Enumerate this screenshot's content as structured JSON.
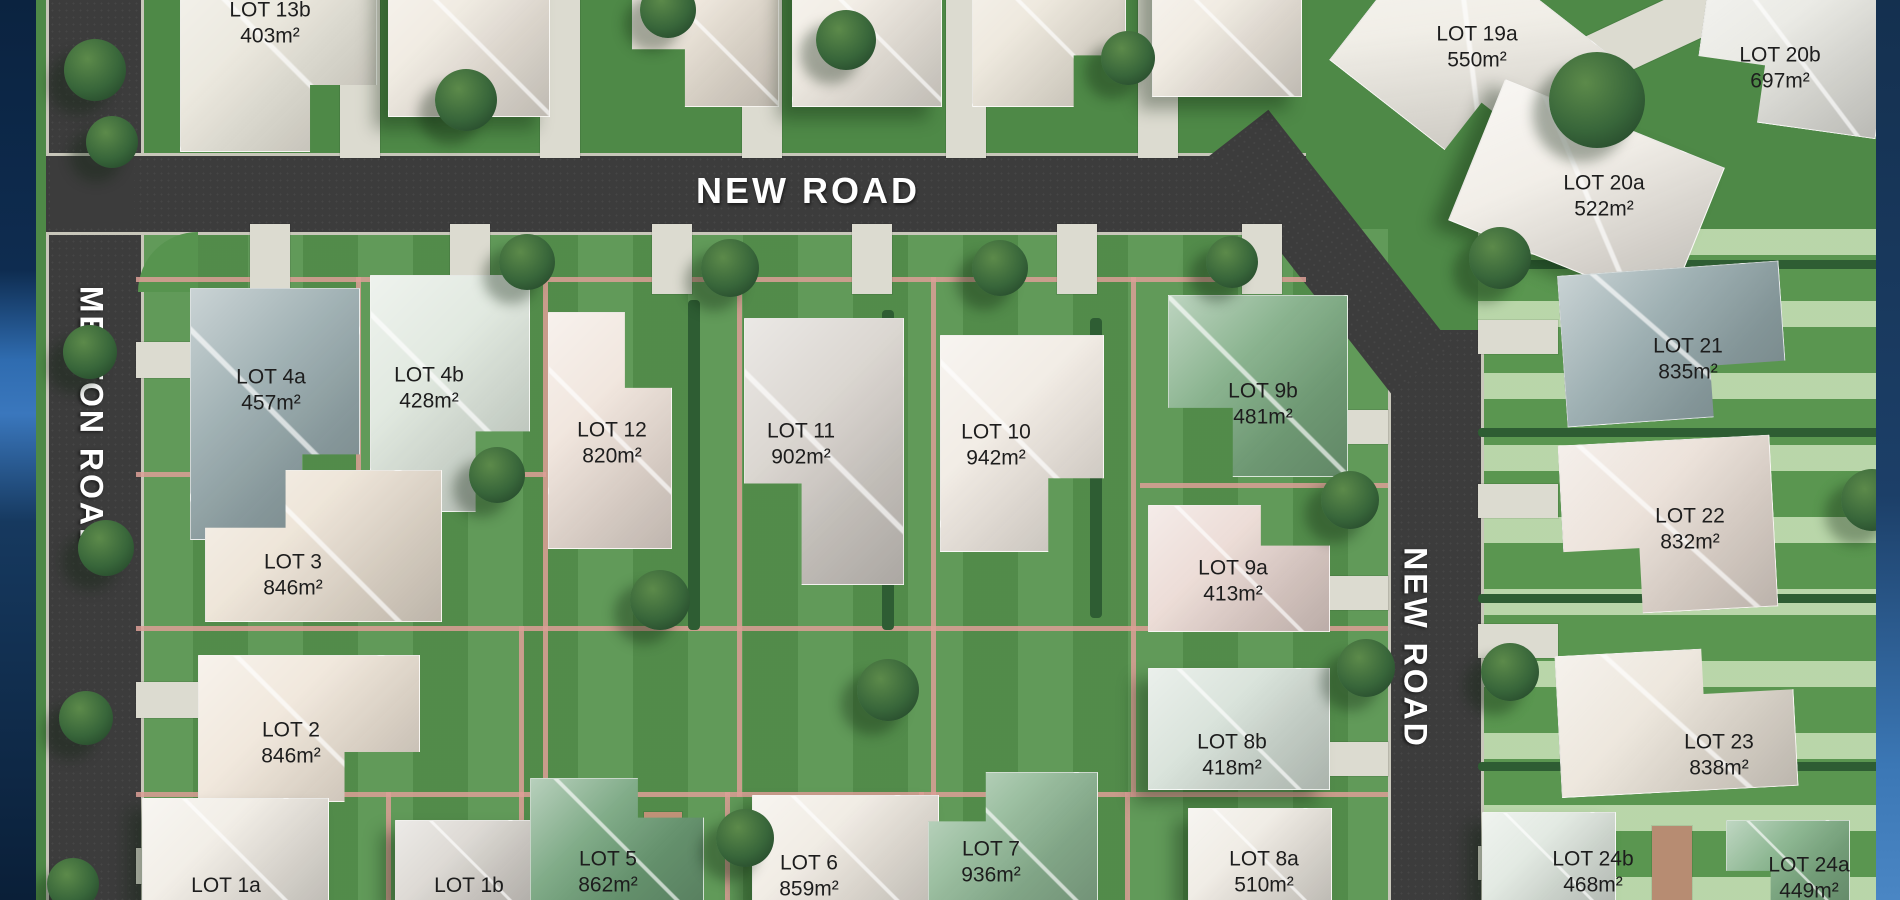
{
  "roads": {
    "melton": {
      "label": "MELTON ROAD",
      "x": 91,
      "y": 420,
      "orientation": "vertical"
    },
    "new_top": {
      "label": "NEW ROAD",
      "x": 808,
      "y": 191,
      "orientation": "horizontal"
    },
    "new_right": {
      "label": "NEW ROAD",
      "x": 1415,
      "y": 648,
      "orientation": "vertical"
    }
  },
  "lots": [
    {
      "id": "LOT 13b",
      "area": "403m²",
      "x": 270,
      "y": 23
    },
    {
      "id": "LOT 19a",
      "area": "550m²",
      "x": 1477,
      "y": 47
    },
    {
      "id": "LOT 20b",
      "area": "697m²",
      "x": 1780,
      "y": 68
    },
    {
      "id": "LOT 20a",
      "area": "522m²",
      "x": 1604,
      "y": 196
    },
    {
      "id": "LOT 4a",
      "area": "457m²",
      "x": 271,
      "y": 390
    },
    {
      "id": "LOT 4b",
      "area": "428m²",
      "x": 429,
      "y": 388
    },
    {
      "id": "LOT 12",
      "area": "820m²",
      "x": 612,
      "y": 443
    },
    {
      "id": "LOT 11",
      "area": "902m²",
      "x": 801,
      "y": 444
    },
    {
      "id": "LOT 10",
      "area": "942m²",
      "x": 996,
      "y": 445
    },
    {
      "id": "LOT 9b",
      "area": "481m²",
      "x": 1263,
      "y": 404
    },
    {
      "id": "LOT 21",
      "area": "835m²",
      "x": 1688,
      "y": 359
    },
    {
      "id": "LOT 3",
      "area": "846m²",
      "x": 293,
      "y": 575
    },
    {
      "id": "LOT 9a",
      "area": "413m²",
      "x": 1233,
      "y": 581
    },
    {
      "id": "LOT 22",
      "area": "832m²",
      "x": 1690,
      "y": 529
    },
    {
      "id": "LOT 2",
      "area": "846m²",
      "x": 291,
      "y": 743
    },
    {
      "id": "LOT 8b",
      "area": "418m²",
      "x": 1232,
      "y": 755
    },
    {
      "id": "LOT 23",
      "area": "838m²",
      "x": 1719,
      "y": 755
    },
    {
      "id": "LOT 1a",
      "area": "",
      "x": 226,
      "y": 886
    },
    {
      "id": "LOT 1b",
      "area": "",
      "x": 469,
      "y": 886
    },
    {
      "id": "LOT 5",
      "area": "862m²",
      "x": 608,
      "y": 872
    },
    {
      "id": "LOT 6",
      "area": "859m²",
      "x": 809,
      "y": 876
    },
    {
      "id": "LOT 7",
      "area": "936m²",
      "x": 991,
      "y": 862
    },
    {
      "id": "LOT 8a",
      "area": "510m²",
      "x": 1264,
      "y": 872
    },
    {
      "id": "LOT 24b",
      "area": "468m²",
      "x": 1593,
      "y": 872
    },
    {
      "id": "LOT 24a",
      "area": "449m²",
      "x": 1809,
      "y": 878
    }
  ],
  "scene": {
    "houses": [
      {
        "x": 180,
        "y": -45,
        "w": 195,
        "h": 195,
        "c": "#e9e6db",
        "rot": 0,
        "shape": "l-br"
      },
      {
        "x": 388,
        "y": -50,
        "w": 160,
        "h": 165,
        "c": "#efe9df",
        "rot": 0,
        "shape": "rect"
      },
      {
        "x": 632,
        "y": -45,
        "w": 145,
        "h": 150,
        "c": "#ece4d8",
        "rot": 0,
        "shape": "l-bl"
      },
      {
        "x": 792,
        "y": -55,
        "w": 148,
        "h": 160,
        "c": "#f0ebe2",
        "rot": 0,
        "shape": "rect"
      },
      {
        "x": 972,
        "y": -45,
        "w": 152,
        "h": 150,
        "c": "#ece6da",
        "rot": 0,
        "shape": "l-br"
      },
      {
        "x": 1152,
        "y": -35,
        "w": 148,
        "h": 130,
        "c": "#efe9df",
        "rot": 0,
        "shape": "rect"
      },
      {
        "x": 1360,
        "y": -30,
        "w": 220,
        "h": 175,
        "c": "#efece4",
        "rot": 38,
        "shape": "l-br"
      },
      {
        "x": 1700,
        "y": -25,
        "w": 185,
        "h": 150,
        "c": "#e8e8e2",
        "rot": 8,
        "shape": "l-bl"
      },
      {
        "x": 1468,
        "y": 118,
        "w": 235,
        "h": 150,
        "c": "#f0ece5",
        "rot": 22,
        "shape": "rect"
      },
      {
        "x": 190,
        "y": 288,
        "w": 168,
        "h": 250,
        "c": "#94a7aa",
        "rot": 0,
        "shape": "l-br"
      },
      {
        "x": 370,
        "y": 275,
        "w": 158,
        "h": 235,
        "c": "#dde6dc",
        "rot": 0,
        "shape": "l-br"
      },
      {
        "x": 548,
        "y": 312,
        "w": 122,
        "h": 235,
        "c": "#efe3da",
        "rot": 0,
        "shape": "l-tr"
      },
      {
        "x": 744,
        "y": 318,
        "w": 158,
        "h": 265,
        "c": "#d6d1cb",
        "rot": 0,
        "shape": "l-bl"
      },
      {
        "x": 940,
        "y": 335,
        "w": 162,
        "h": 215,
        "c": "#f0eae2",
        "rot": 0,
        "shape": "l-br"
      },
      {
        "x": 1168,
        "y": 295,
        "w": 178,
        "h": 180,
        "c": "#7aa980",
        "rot": 0,
        "shape": "l-bl"
      },
      {
        "x": 1562,
        "y": 268,
        "w": 220,
        "h": 150,
        "c": "#92a6a9",
        "rot": -4,
        "shape": "l-br"
      },
      {
        "x": 205,
        "y": 470,
        "w": 235,
        "h": 150,
        "c": "#ece2d4",
        "rot": 0,
        "shape": "l-tl"
      },
      {
        "x": 1148,
        "y": 505,
        "w": 180,
        "h": 125,
        "c": "#ead8d2",
        "rot": 0,
        "shape": "l-tr"
      },
      {
        "x": 1562,
        "y": 440,
        "w": 210,
        "h": 170,
        "c": "#eadfd6",
        "rot": -3,
        "shape": "l-bl"
      },
      {
        "x": 198,
        "y": 655,
        "w": 220,
        "h": 145,
        "c": "#efe5d8",
        "rot": 0,
        "shape": "l-br"
      },
      {
        "x": 1148,
        "y": 668,
        "w": 180,
        "h": 120,
        "c": "#d5e0d7",
        "rot": 0,
        "shape": "rect"
      },
      {
        "x": 1558,
        "y": 650,
        "w": 235,
        "h": 140,
        "c": "#ebe4d9",
        "rot": -3,
        "shape": "l-tr"
      },
      {
        "x": 142,
        "y": 798,
        "w": 185,
        "h": 102,
        "c": "#f0ece4",
        "rot": 0,
        "shape": "rect"
      },
      {
        "x": 395,
        "y": 820,
        "w": 150,
        "h": 80,
        "c": "#d9d5cf",
        "rot": 0,
        "shape": "rect"
      },
      {
        "x": 530,
        "y": 778,
        "w": 172,
        "h": 122,
        "c": "#6fa078",
        "rot": 0,
        "shape": "l-tr"
      },
      {
        "x": 752,
        "y": 795,
        "w": 185,
        "h": 105,
        "c": "#efeae1",
        "rot": 0,
        "shape": "rect"
      },
      {
        "x": 928,
        "y": 772,
        "w": 168,
        "h": 128,
        "c": "#8fb795",
        "rot": 0,
        "shape": "l-tl"
      },
      {
        "x": 1188,
        "y": 808,
        "w": 142,
        "h": 92,
        "c": "#eeeae2",
        "rot": 0,
        "shape": "rect"
      },
      {
        "x": 1482,
        "y": 812,
        "w": 132,
        "h": 88,
        "c": "#dfe7df",
        "rot": 0,
        "shape": "rect"
      },
      {
        "x": 1726,
        "y": 820,
        "w": 122,
        "h": 80,
        "c": "#7fae85",
        "rot": 0,
        "shape": "l-bl"
      }
    ],
    "trees": [
      {
        "x": 95,
        "y": 70,
        "d": 62
      },
      {
        "x": 112,
        "y": 142,
        "d": 52
      },
      {
        "x": 466,
        "y": 100,
        "d": 62
      },
      {
        "x": 668,
        "y": 10,
        "d": 56
      },
      {
        "x": 846,
        "y": 40,
        "d": 60
      },
      {
        "x": 1128,
        "y": 58,
        "d": 54
      },
      {
        "x": 527,
        "y": 262,
        "d": 56
      },
      {
        "x": 730,
        "y": 268,
        "d": 58
      },
      {
        "x": 1000,
        "y": 268,
        "d": 56
      },
      {
        "x": 1232,
        "y": 262,
        "d": 52
      },
      {
        "x": 1597,
        "y": 100,
        "d": 96
      },
      {
        "x": 1500,
        "y": 258,
        "d": 62
      },
      {
        "x": 497,
        "y": 475,
        "d": 56
      },
      {
        "x": 660,
        "y": 600,
        "d": 60
      },
      {
        "x": 888,
        "y": 690,
        "d": 62
      },
      {
        "x": 745,
        "y": 838,
        "d": 58
      },
      {
        "x": 90,
        "y": 352,
        "d": 54
      },
      {
        "x": 106,
        "y": 548,
        "d": 56
      },
      {
        "x": 86,
        "y": 718,
        "d": 54
      },
      {
        "x": 73,
        "y": 884,
        "d": 52
      },
      {
        "x": 1350,
        "y": 500,
        "d": 58
      },
      {
        "x": 1366,
        "y": 668,
        "d": 58
      },
      {
        "x": 1872,
        "y": 500,
        "d": 62
      },
      {
        "x": 1510,
        "y": 672,
        "d": 58
      }
    ],
    "driveways": [
      {
        "x": 340,
        "y": 0,
        "w": 40,
        "h": 158
      },
      {
        "x": 540,
        "y": 0,
        "w": 40,
        "h": 158
      },
      {
        "x": 742,
        "y": 0,
        "w": 40,
        "h": 158
      },
      {
        "x": 946,
        "y": 0,
        "w": 40,
        "h": 158
      },
      {
        "x": 1138,
        "y": 0,
        "w": 40,
        "h": 158
      },
      {
        "x": 250,
        "y": 224,
        "w": 40,
        "h": 70
      },
      {
        "x": 450,
        "y": 224,
        "w": 40,
        "h": 70
      },
      {
        "x": 652,
        "y": 224,
        "w": 40,
        "h": 70
      },
      {
        "x": 852,
        "y": 224,
        "w": 40,
        "h": 70
      },
      {
        "x": 1057,
        "y": 224,
        "w": 40,
        "h": 70
      },
      {
        "x": 1242,
        "y": 224,
        "w": 40,
        "h": 70
      },
      {
        "x": 136,
        "y": 342,
        "w": 78,
        "h": 36
      },
      {
        "x": 136,
        "y": 682,
        "w": 78,
        "h": 36
      },
      {
        "x": 136,
        "y": 848,
        "w": 78,
        "h": 36
      },
      {
        "x": 1306,
        "y": 410,
        "w": 82,
        "h": 34
      },
      {
        "x": 1306,
        "y": 576,
        "w": 82,
        "h": 34
      },
      {
        "x": 1306,
        "y": 742,
        "w": 82,
        "h": 34
      },
      {
        "x": 1478,
        "y": 320,
        "w": 80,
        "h": 34
      },
      {
        "x": 1478,
        "y": 484,
        "w": 80,
        "h": 34
      },
      {
        "x": 1478,
        "y": 624,
        "w": 80,
        "h": 34
      },
      {
        "x": 1478,
        "y": 846,
        "w": 80,
        "h": 34
      },
      {
        "x": 1480,
        "y": 30,
        "w": 250,
        "h": 50,
        "rot": -25
      },
      {
        "x": 644,
        "y": 812,
        "w": 38,
        "h": 88,
        "c": "#c09177"
      },
      {
        "x": 1652,
        "y": 826,
        "w": 40,
        "h": 74,
        "c": "#b78c72"
      }
    ],
    "fences": [
      {
        "x": 136,
        "y": 277,
        "w": 1170,
        "h": 5
      },
      {
        "x": 136,
        "y": 472,
        "w": 410,
        "h": 5
      },
      {
        "x": 1140,
        "y": 483,
        "w": 248,
        "h": 5
      },
      {
        "x": 136,
        "y": 626,
        "w": 1252,
        "h": 5
      },
      {
        "x": 136,
        "y": 792,
        "w": 1252,
        "h": 5
      },
      {
        "x": 356,
        "y": 277,
        "w": 5,
        "h": 200
      },
      {
        "x": 543,
        "y": 277,
        "w": 5,
        "h": 520
      },
      {
        "x": 737,
        "y": 277,
        "w": 5,
        "h": 520
      },
      {
        "x": 931,
        "y": 277,
        "w": 5,
        "h": 520
      },
      {
        "x": 1131,
        "y": 277,
        "w": 5,
        "h": 520
      },
      {
        "x": 519,
        "y": 626,
        "w": 5,
        "h": 171
      },
      {
        "x": 386,
        "y": 792,
        "w": 5,
        "h": 108
      },
      {
        "x": 519,
        "y": 792,
        "w": 5,
        "h": 108
      },
      {
        "x": 725,
        "y": 792,
        "w": 5,
        "h": 108
      },
      {
        "x": 919,
        "y": 792,
        "w": 5,
        "h": 108
      },
      {
        "x": 1125,
        "y": 792,
        "w": 5,
        "h": 108
      }
    ],
    "hedges": [
      {
        "x": 1478,
        "y": 260,
        "w": 422,
        "h": 9
      },
      {
        "x": 1478,
        "y": 428,
        "w": 422,
        "h": 9
      },
      {
        "x": 1478,
        "y": 594,
        "w": 422,
        "h": 9
      },
      {
        "x": 1478,
        "y": 762,
        "w": 422,
        "h": 9
      },
      {
        "x": 688,
        "y": 300,
        "w": 12,
        "h": 330
      },
      {
        "x": 882,
        "y": 310,
        "w": 12,
        "h": 320
      },
      {
        "x": 1090,
        "y": 318,
        "w": 12,
        "h": 300
      }
    ]
  },
  "colors": {
    "road": "#3c3c3c",
    "curb": "#c8c7ba",
    "grass": "#4e8947",
    "grass_block": "#57944f",
    "lawn_stripe": "#bed8ab",
    "driveway": "#dcdbd0",
    "fence": "#dd9f96",
    "hedge": "#2e5d33",
    "road_text": "#ffffff",
    "lot_text": "#1d1d1d",
    "border_blue_dark": "#0d2846",
    "border_blue_light": "#3a77bd"
  }
}
